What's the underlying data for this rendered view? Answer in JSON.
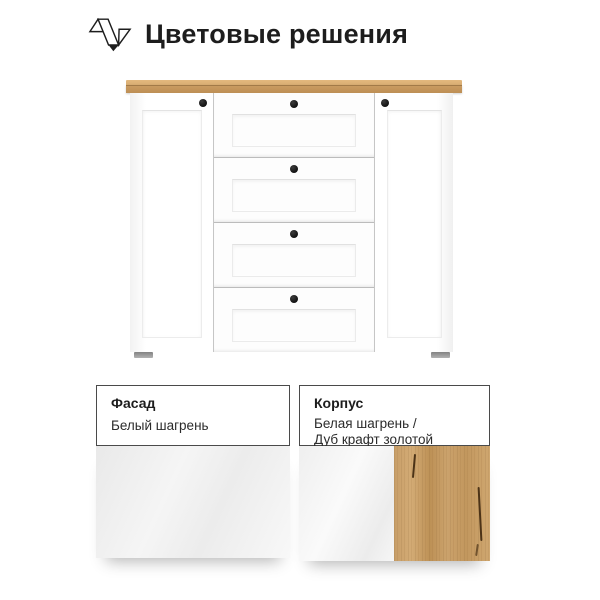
{
  "header": {
    "title": "Цветовые решения",
    "logo_icon": "zigzag-ribbon-logo"
  },
  "product": {
    "description": "Белый комод с четырьмя ящиками, двумя дверцами и столешницей из дуба",
    "knob_count": 6,
    "drawer_count": 4,
    "door_count": 2
  },
  "colors": {
    "text": "#1d1d1d",
    "wood_top": "#d8ad72",
    "wood_front": "#cb9c62",
    "body_white": "#fdfdfd",
    "knob": "#121212",
    "feet_gray": "#b2b2b2",
    "border_dark": "#4a4a4a",
    "oak_base": "#bd9156"
  },
  "cards": [
    {
      "title": "Фасад",
      "values": [
        "Белый шагрень"
      ],
      "swatches": [
        "white-shagreen"
      ]
    },
    {
      "title": "Корпус",
      "values": [
        "Белая шагрень /",
        "Дуб крафт золотой"
      ],
      "swatches": [
        "white-shagreen",
        "oak-craft-gold"
      ]
    }
  ]
}
